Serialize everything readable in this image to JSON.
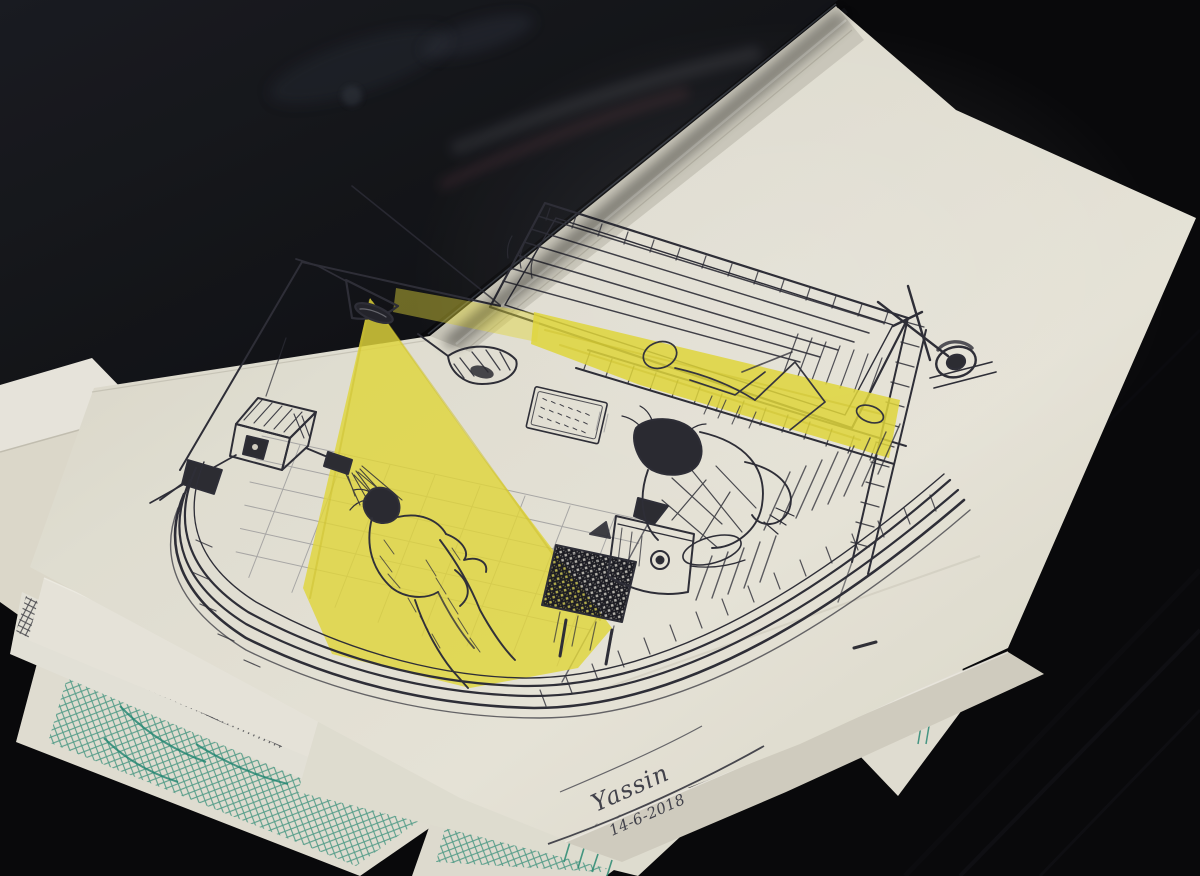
{
  "photo": {
    "description": "Stack of hand-drawn sketches lying on a dark table. The top cream sheet is a ballpoint-pen drawing of a room: one figure showers in a tiled stall under the yellow beam of a hanging cone lamp, another figure sits hunched beside a bed while a third reclines in yellow light streaming through window blinds. Signed Yassin, dated 14-6-2018. Other sheets beneath show teal-ink and pencil sketches.",
    "medium": "ballpoint pen and yellow highlighter on cream paper",
    "visible_objects": [
      "window blinds",
      "yellow light beam from window",
      "hanging cone lamp",
      "yellow lamp beam",
      "tiled shower wall",
      "shower head",
      "standing bathing figure",
      "sitting hunched figure",
      "reclining figure",
      "bed and floor edge lines",
      "dark hatched stool",
      "lidded water pot",
      "wall calendar",
      "wall lamp",
      "corner clock with antenna",
      "house-shaped box",
      "handwritten signature",
      "teal crosshatch sketch",
      "pencil hatch sketch",
      "black portfolio cover"
    ]
  },
  "signature": {
    "name": "Yassin",
    "date": "14-6-2018"
  },
  "colors": {
    "table_black": "#0b0b0d",
    "portfolio_black": "#17191e",
    "paper_cream": "#eceadf",
    "paper_shadow": "#d2cfc2",
    "ink": "#30303a",
    "highlight_yellow": "#e9de3e",
    "teal_ink": "#1f8a74",
    "pencil_gray": "#4e4e56"
  }
}
